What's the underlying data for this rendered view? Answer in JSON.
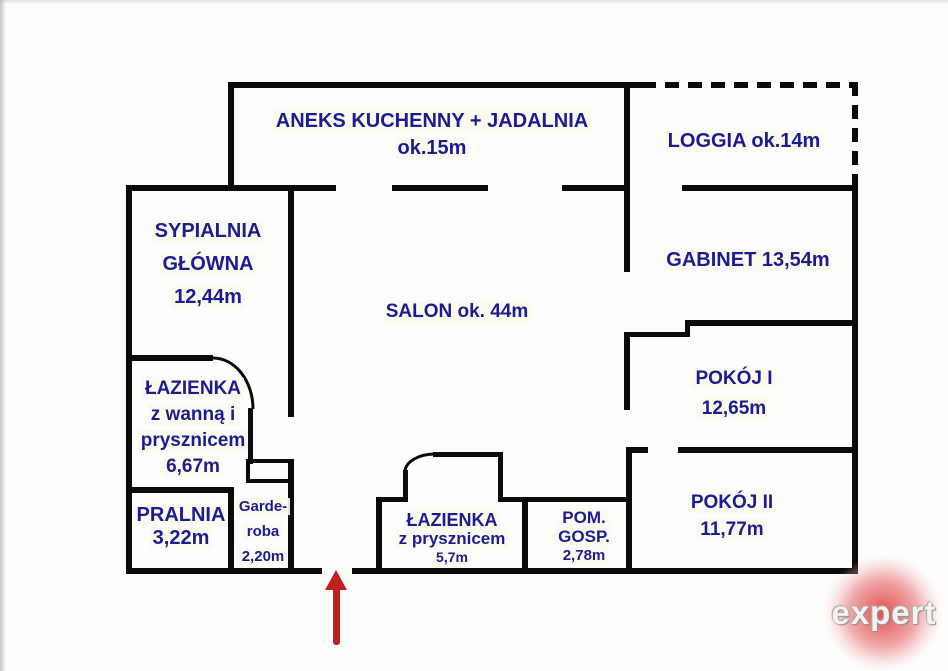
{
  "rooms": {
    "kitchen": {
      "lines": [
        "ANEKS KUCHENNY + JADALNIA",
        "ok.15m"
      ]
    },
    "loggia": {
      "lines": [
        "LOGGIA ok.14m"
      ]
    },
    "sypialnia": {
      "lines": [
        "SYPIALNIA",
        "GŁÓWNA",
        "12,44m"
      ]
    },
    "salon": {
      "lines": [
        "SALON ok. 44m"
      ]
    },
    "gabinet": {
      "lines": [
        "GABINET 13,54m"
      ]
    },
    "pokoj1": {
      "lines": [
        "POKÓJ I",
        "12,65m"
      ]
    },
    "pokoj2": {
      "lines": [
        "POKÓJ II",
        "11,77m"
      ]
    },
    "bathroom_main": {
      "lines": [
        "ŁAZIENKA",
        "z wanną i",
        "prysznicem",
        "6,67m"
      ]
    },
    "pralnia": {
      "lines": [
        "PRALNIA",
        "3,22m"
      ]
    },
    "wardrobe": {
      "lines": [
        "Garde-",
        "roba",
        "2,20m"
      ]
    },
    "bathroom_small": {
      "lines": [
        "ŁAZIENKA",
        "z prysznicem",
        "5,7m"
      ]
    },
    "utility": {
      "lines": [
        "POM.",
        "GOSP.",
        "2,78m"
      ]
    }
  },
  "watermark": {
    "text": "expert"
  },
  "colors": {
    "label_text": "#1c1c90",
    "wall": "#0b0b0b",
    "entrance_arrow": "#c12020",
    "watermark_red": "#dc3737"
  }
}
